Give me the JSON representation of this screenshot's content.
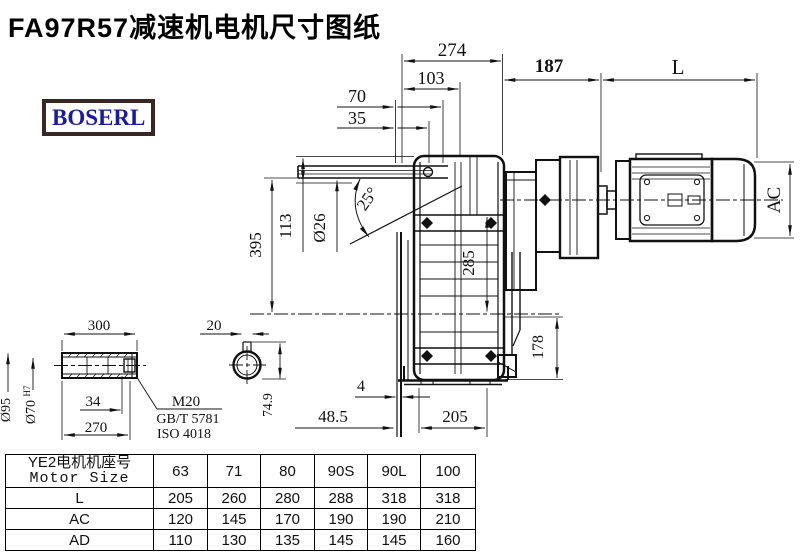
{
  "title": "FA97R57减速机电机尺寸图纸",
  "logo": "BOSERL",
  "drawing": {
    "dims": {
      "depth_274": "274",
      "depth_103": "103",
      "depth_70": "70",
      "depth_35": "35",
      "motor_gap_187": "187",
      "motor_length_L": "L",
      "motor_dia_AC": "AC",
      "height_395": "395",
      "height_113": "113",
      "rod_dia": "Ø26",
      "swing_angle": "25°",
      "flange_285": "285",
      "bottom_178": "178",
      "lip_4": "4",
      "offset_48_5": "48.5",
      "base_205": "205",
      "shaft_300": "300",
      "shaft_270": "270",
      "thread_34": "34",
      "shaft_od": "Ø95",
      "bore": "Ø70",
      "bore_tol": "H7",
      "thread_m20": "M20",
      "std_gbt": "GB/T 5781",
      "std_iso": "ISO 4018",
      "key_20": "20",
      "key_74_9": "74.9"
    }
  },
  "table": {
    "header_cn": "YE2电机机座号",
    "header_en": "Motor Size",
    "columns": [
      "63",
      "71",
      "80",
      "90S",
      "90L",
      "100"
    ],
    "rows": [
      {
        "label": "L",
        "values": [
          "205",
          "260",
          "280",
          "288",
          "318",
          "318"
        ]
      },
      {
        "label": "AC",
        "values": [
          "120",
          "145",
          "170",
          "190",
          "190",
          "210"
        ]
      },
      {
        "label": "AD",
        "values": [
          "110",
          "130",
          "135",
          "145",
          "145",
          "160"
        ]
      }
    ]
  }
}
